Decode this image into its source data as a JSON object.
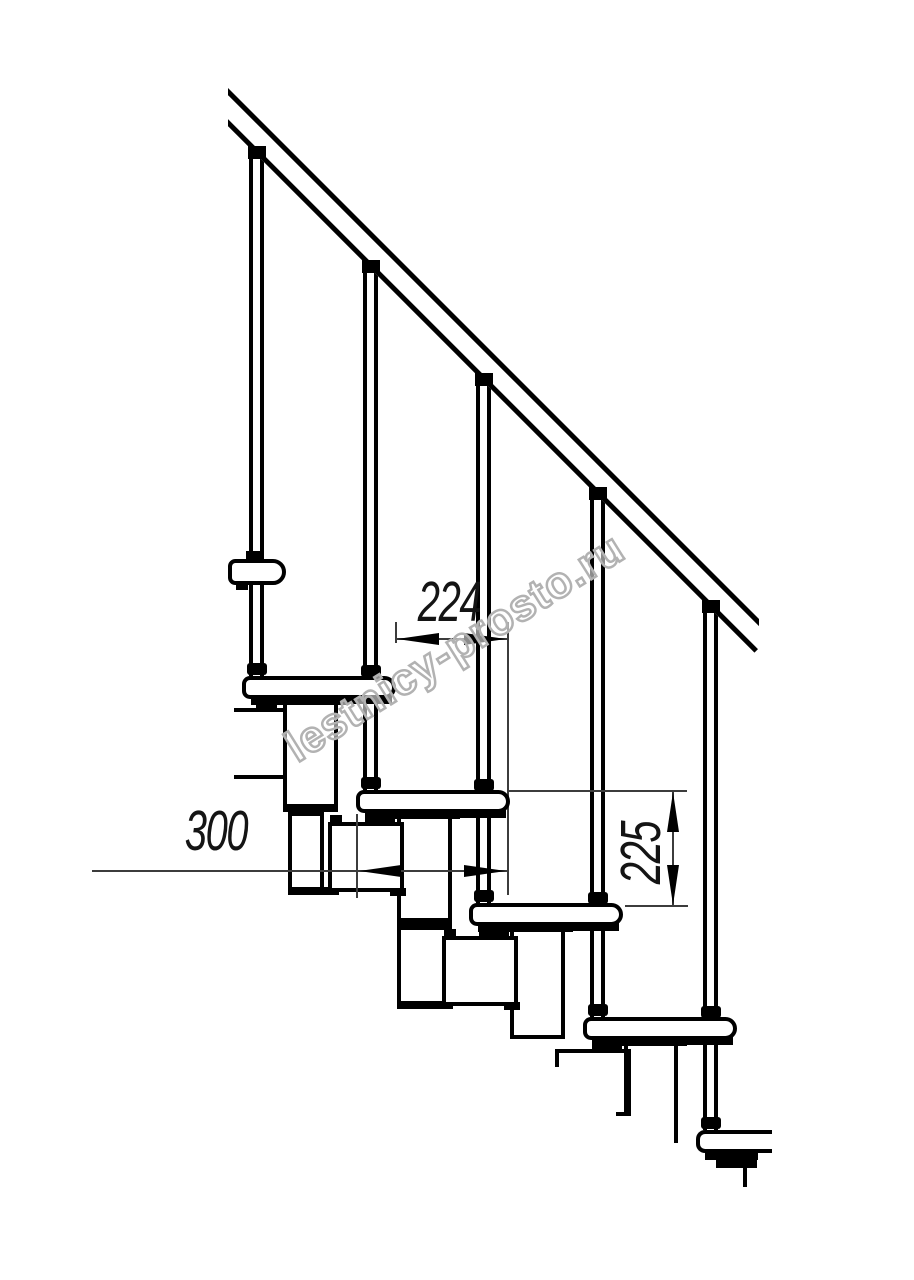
{
  "figure": {
    "type": "technical-drawing",
    "subject": "modular staircase side elevation with handrail and balusters",
    "dimensions": [
      {
        "id": "step-run",
        "label": "224",
        "orientation": "horizontal"
      },
      {
        "id": "tread-depth",
        "label": "300",
        "orientation": "horizontal"
      },
      {
        "id": "step-rise",
        "label": "225",
        "orientation": "vertical"
      }
    ],
    "watermark": "lestnicy-prosto.ru",
    "components": {
      "treads": 5,
      "balusters": 5,
      "handrails": 1
    }
  },
  "colors": {
    "line": "#000000",
    "dim_line": "#3c3c3c",
    "text": "#141414",
    "watermark_outline": "#b2b2b2",
    "background": "#ffffff"
  }
}
